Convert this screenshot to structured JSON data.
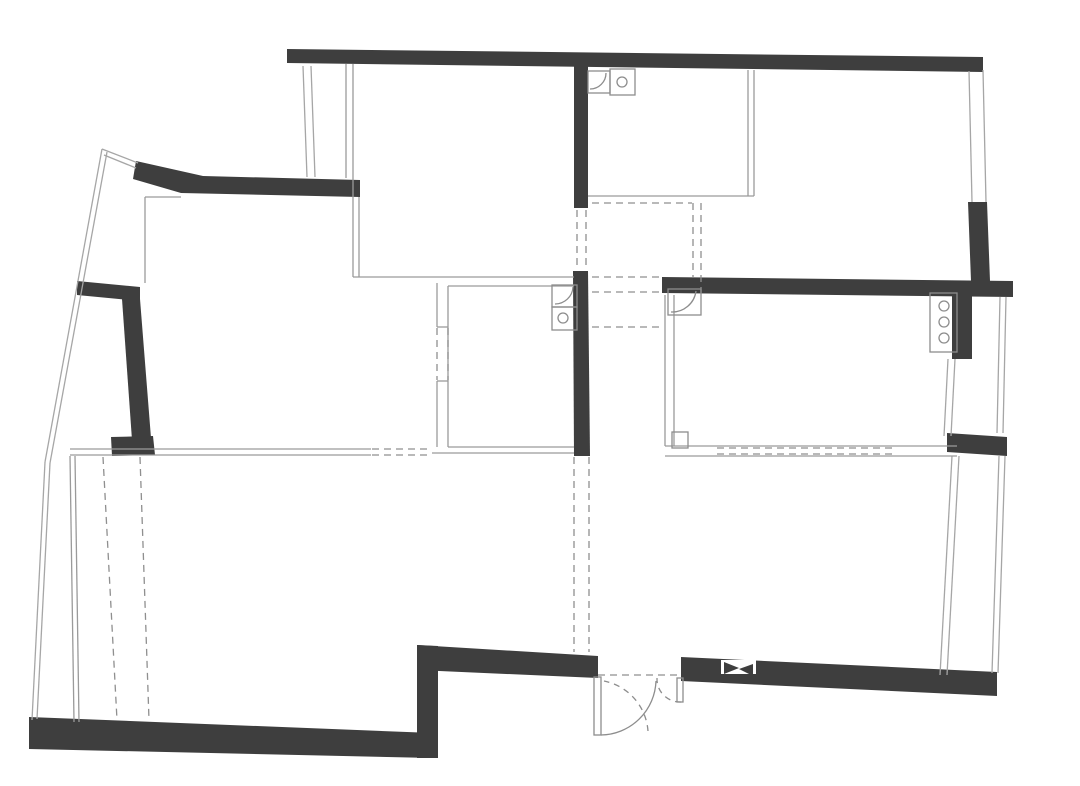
{
  "canvas": {
    "width": 1080,
    "height": 786,
    "background": "#ffffff"
  },
  "palette": {
    "wall": "#3e3e3e",
    "window_line": "#a6a6a6",
    "thin_line": "#9a9a9a",
    "dashed_line": "#8f8f8f",
    "fixture_line": "#8d8d8d",
    "white": "#ffffff"
  },
  "floorplan": {
    "walls": [
      {
        "name": "top-wall",
        "points": "287,49 983,57 983,72 287,63"
      },
      {
        "name": "top-left-angled-wall",
        "points": "136,161 203,176 360,180 360,197 181,193 133,179"
      },
      {
        "name": "left-balcony-bar-wall",
        "points": "77,281 140,287 140,301 77,295"
      },
      {
        "name": "left-wall",
        "points": "122,299 140,299 151,438 132,440"
      },
      {
        "name": "left-wall-foot",
        "points": "111,437 153,436 155,455 112,456"
      },
      {
        "name": "bottom-left-wall",
        "points": "29,717 433,733 433,758 29,749"
      },
      {
        "name": "step-wall",
        "points": "417,645 438,646 438,758 417,758"
      },
      {
        "name": "entry-left-wall",
        "points": "417,645 598,656 598,678 417,670"
      },
      {
        "name": "bottom-right-wall",
        "points": "681,657 997,672 997,696 681,681"
      },
      {
        "name": "central-wall-upper",
        "points": "574,62 588,63 588,208 574,208"
      },
      {
        "name": "central-wall-lower",
        "points": "573,271 588,271 590,456 574,456"
      },
      {
        "name": "mid-right-wall",
        "points": "662,277 1013,281 1013,297 662,293"
      },
      {
        "name": "right-upper-wall",
        "points": "968,202 987,202 990,281 971,281"
      },
      {
        "name": "right-mid-wall",
        "points": "952,296 972,296 972,359 952,359"
      },
      {
        "name": "right-block-wall",
        "points": "947,433 1007,437 1007,456 947,452"
      }
    ],
    "window_lines": [
      {
        "name": "window-topleft-a",
        "x1": 303,
        "y1": 66,
        "x2": 307,
        "y2": 177
      },
      {
        "name": "window-topleft-b",
        "x1": 311,
        "y1": 66,
        "x2": 315,
        "y2": 177
      },
      {
        "name": "balcony-edge-upper-a",
        "x1": 102,
        "y1": 149,
        "x2": 45,
        "y2": 462
      },
      {
        "name": "balcony-edge-lower-a",
        "x1": 45,
        "y1": 462,
        "x2": 32,
        "y2": 720
      },
      {
        "name": "balcony-edge-upper-b",
        "x1": 107,
        "y1": 152,
        "x2": 50,
        "y2": 463
      },
      {
        "name": "balcony-edge-lower-b",
        "x1": 50,
        "y1": 463,
        "x2": 37,
        "y2": 719
      },
      {
        "name": "balcony-top-link-a",
        "x1": 102,
        "y1": 149,
        "x2": 138,
        "y2": 163
      },
      {
        "name": "balcony-top-link-b",
        "x1": 104,
        "y1": 155,
        "x2": 136,
        "y2": 168
      },
      {
        "name": "window-righttop-a",
        "x1": 969,
        "y1": 71,
        "x2": 972,
        "y2": 202
      },
      {
        "name": "window-righttop-b",
        "x1": 983,
        "y1": 70,
        "x2": 986,
        "y2": 202
      },
      {
        "name": "right-face-upper-a",
        "x1": 1000,
        "y1": 297,
        "x2": 997,
        "y2": 433
      },
      {
        "name": "right-face-upper-b",
        "x1": 1006,
        "y1": 297,
        "x2": 1003,
        "y2": 433
      },
      {
        "name": "window-rightmid-a",
        "x1": 948,
        "y1": 359,
        "x2": 944,
        "y2": 436
      },
      {
        "name": "window-rightmid-b",
        "x1": 955,
        "y1": 359,
        "x2": 951,
        "y2": 436
      },
      {
        "name": "window-rightlow-inner-a",
        "x1": 952,
        "y1": 456,
        "x2": 940,
        "y2": 675
      },
      {
        "name": "window-rightlow-inner-b",
        "x1": 959,
        "y1": 456,
        "x2": 947,
        "y2": 675
      },
      {
        "name": "window-rightlow-outer-a",
        "x1": 999,
        "y1": 456,
        "x2": 992,
        "y2": 673
      },
      {
        "name": "window-rightlow-outer-b",
        "x1": 1005,
        "y1": 456,
        "x2": 998,
        "y2": 673
      }
    ],
    "thin_lines": [
      {
        "name": "topleft-interior-v",
        "x1": 145,
        "y1": 197,
        "x2": 145,
        "y2": 283
      },
      {
        "name": "topleft-interior-h",
        "x1": 145,
        "y1": 197,
        "x2": 181,
        "y2": 197
      },
      {
        "name": "topmid-left-a",
        "x1": 346,
        "y1": 64,
        "x2": 346,
        "y2": 178
      },
      {
        "name": "topmid-left-b",
        "x1": 353,
        "y1": 64,
        "x2": 353,
        "y2": 277
      },
      {
        "name": "topmid-left-c",
        "x1": 359,
        "y1": 197,
        "x2": 359,
        "y2": 277
      },
      {
        "name": "topmid-room-bottom",
        "x1": 353,
        "y1": 277,
        "x2": 574,
        "y2": 277
      },
      {
        "name": "lower-left-inner-a",
        "x1": 70,
        "y1": 456,
        "x2": 74,
        "y2": 722
      },
      {
        "name": "lower-left-inner-b",
        "x1": 75,
        "y1": 456,
        "x2": 79,
        "y2": 722
      },
      {
        "name": "mid-bottom-a",
        "x1": 70,
        "y1": 449,
        "x2": 371,
        "y2": 449
      },
      {
        "name": "mid-bottom-b",
        "x1": 70,
        "y1": 455,
        "x2": 371,
        "y2": 455
      },
      {
        "name": "bath-left-wall-l",
        "x1": 448,
        "y1": 286,
        "x2": 448,
        "y2": 447
      },
      {
        "name": "bath-left-top",
        "x1": 448,
        "y1": 286,
        "x2": 574,
        "y2": 286
      },
      {
        "name": "bath-left-bottom-a",
        "x1": 448,
        "y1": 447,
        "x2": 574,
        "y2": 447
      },
      {
        "name": "bath-left-bottom-b",
        "x1": 432,
        "y1": 453,
        "x2": 574,
        "y2": 453
      },
      {
        "name": "partition-solid-top",
        "x1": 437,
        "y1": 283,
        "x2": 437,
        "y2": 327
      },
      {
        "name": "partition-solid-bottom",
        "x1": 437,
        "y1": 381,
        "x2": 437,
        "y2": 447
      },
      {
        "name": "partition-tick-a",
        "x1": 437,
        "y1": 327,
        "x2": 448,
        "y2": 327
      },
      {
        "name": "partition-tick-b",
        "x1": 437,
        "y1": 381,
        "x2": 448,
        "y2": 381
      },
      {
        "name": "bath-right-left-a",
        "x1": 665,
        "y1": 295,
        "x2": 665,
        "y2": 446
      },
      {
        "name": "bath-right-left-b",
        "x1": 674,
        "y1": 295,
        "x2": 674,
        "y2": 446
      },
      {
        "name": "bath-right-bottom-a",
        "x1": 665,
        "y1": 446,
        "x2": 957,
        "y2": 446
      },
      {
        "name": "bath-right-bottom-b",
        "x1": 665,
        "y1": 456,
        "x2": 957,
        "y2": 456
      },
      {
        "name": "topright-room-bottom",
        "x1": 588,
        "y1": 196,
        "x2": 754,
        "y2": 196
      },
      {
        "name": "topright-partition-a",
        "x1": 748,
        "y1": 70,
        "x2": 748,
        "y2": 196
      },
      {
        "name": "topright-partition-b",
        "x1": 754,
        "y1": 70,
        "x2": 754,
        "y2": 196
      }
    ],
    "dashed_lines": [
      {
        "name": "central-opening-a",
        "x1": 577,
        "y1": 210,
        "x2": 577,
        "y2": 269
      },
      {
        "name": "central-opening-b",
        "x1": 586,
        "y1": 210,
        "x2": 586,
        "y2": 269
      },
      {
        "name": "hall-dash-h1",
        "x1": 592,
        "y1": 277,
        "x2": 661,
        "y2": 277
      },
      {
        "name": "hall-dash-h2",
        "x1": 592,
        "y1": 292,
        "x2": 661,
        "y2": 292
      },
      {
        "name": "hall-dash-h3",
        "x1": 592,
        "y1": 327,
        "x2": 661,
        "y2": 327
      },
      {
        "name": "topright-dash-h",
        "x1": 592,
        "y1": 203,
        "x2": 692,
        "y2": 203
      },
      {
        "name": "topright-dash-v1",
        "x1": 693,
        "y1": 203,
        "x2": 693,
        "y2": 277
      },
      {
        "name": "topright-dash-v2",
        "x1": 701,
        "y1": 203,
        "x2": 701,
        "y2": 293
      },
      {
        "name": "partition-dash-a",
        "x1": 437,
        "y1": 328,
        "x2": 437,
        "y2": 380
      },
      {
        "name": "partition-dash-b",
        "x1": 448,
        "y1": 328,
        "x2": 448,
        "y2": 380
      },
      {
        "name": "midgap-dash-a",
        "x1": 372,
        "y1": 449,
        "x2": 432,
        "y2": 449
      },
      {
        "name": "midgap-dash-b",
        "x1": 372,
        "y1": 455,
        "x2": 432,
        "y2": 455
      },
      {
        "name": "hallway-dash-v1",
        "x1": 574,
        "y1": 457,
        "x2": 574,
        "y2": 652
      },
      {
        "name": "hallway-dash-v2",
        "x1": 589,
        "y1": 457,
        "x2": 589,
        "y2": 652
      },
      {
        "name": "livingroom-dash-v1",
        "x1": 103,
        "y1": 457,
        "x2": 117,
        "y2": 720
      },
      {
        "name": "livingroom-dash-v2",
        "x1": 140,
        "y1": 457,
        "x2": 149,
        "y2": 720
      },
      {
        "name": "bedroom-dash-a",
        "x1": 717,
        "y1": 448,
        "x2": 892,
        "y2": 448
      },
      {
        "name": "bedroom-dash-b",
        "x1": 717,
        "y1": 454,
        "x2": 892,
        "y2": 454
      },
      {
        "name": "door-threshold-dash",
        "x1": 598,
        "y1": 675,
        "x2": 681,
        "y2": 675
      }
    ],
    "paths": [
      {
        "name": "door-swing-arc",
        "d": "M 656 681 A 56 56 0 0 1 601 735",
        "dashed": false
      },
      {
        "name": "door-swing-arc-dashed",
        "d": "M 648 731 A 55 55 0 0 0 604 681",
        "dashed": true
      },
      {
        "name": "small-leaf-arc",
        "d": "M 681 702 A 23 23 0 0 1 657 678",
        "dashed": true
      },
      {
        "name": "sink-top-arc",
        "d": "M 606 73 A 16 16 0 0 1 590 89",
        "dashed": false
      },
      {
        "name": "sink-left-arc",
        "d": "M 573 287 A 18 18 0 0 1 555 304",
        "dashed": false
      },
      {
        "name": "sink-right-arc",
        "d": "M 696 291 A 24 24 0 0 1 671 312",
        "dashed": false
      }
    ],
    "fixture_rects": [
      {
        "name": "kitchen-sink-basin-a",
        "x": 588,
        "y": 71,
        "w": 22,
        "h": 22
      },
      {
        "name": "kitchen-sink-basin-b",
        "x": 610,
        "y": 69,
        "w": 25,
        "h": 26
      },
      {
        "name": "bath-left-sink",
        "x": 552,
        "y": 285,
        "w": 25,
        "h": 22
      },
      {
        "name": "bath-left-toilet",
        "x": 552,
        "y": 307,
        "w": 25,
        "h": 23
      },
      {
        "name": "bath-right-sink",
        "x": 668,
        "y": 289,
        "w": 33,
        "h": 26
      },
      {
        "name": "corner-box",
        "x": 672,
        "y": 432,
        "w": 16,
        "h": 16
      },
      {
        "name": "heater-cabinet",
        "x": 930,
        "y": 293,
        "w": 27,
        "h": 59
      },
      {
        "name": "entry-door-leaf-main",
        "x": 594,
        "y": 677,
        "w": 7,
        "h": 58
      },
      {
        "name": "entry-door-leaf-small",
        "x": 677,
        "y": 678,
        "w": 6,
        "h": 24
      }
    ],
    "fixture_circles": [
      {
        "name": "kitchen-sink-drain",
        "cx": 622,
        "cy": 82,
        "r": 5
      },
      {
        "name": "toilet-drain",
        "cx": 563,
        "cy": 318,
        "r": 5
      },
      {
        "name": "heater-knob-1",
        "cx": 944,
        "cy": 306,
        "r": 5
      },
      {
        "name": "heater-knob-2",
        "cx": 944,
        "cy": 322,
        "r": 5
      },
      {
        "name": "heater-knob-3",
        "cx": 944,
        "cy": 338,
        "r": 5
      }
    ],
    "bowtie": {
      "base": {
        "name": "wall-vent-base",
        "x": 721,
        "y": 660,
        "w": 35,
        "h": 14
      },
      "triangles": [
        {
          "name": "wall-vent-triangle-left",
          "points": "724,662 724,674 739,668"
        },
        {
          "name": "wall-vent-triangle-right",
          "points": "753,664 753,676 739,669"
        }
      ]
    }
  }
}
